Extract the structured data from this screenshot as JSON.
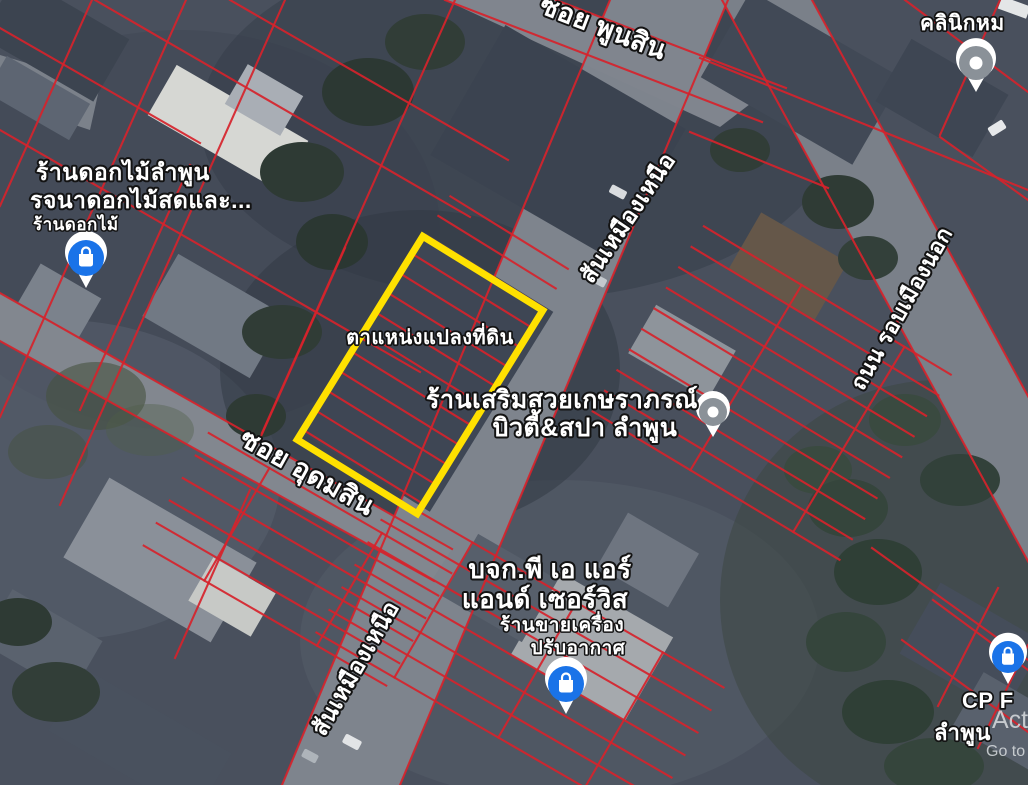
{
  "app": {
    "name": "satellite-map-with-land-parcel-overlay"
  },
  "colors": {
    "parcel_line": "#d6232b",
    "plot_outline": "#ffe100",
    "poi_blue": "#1a73e8",
    "poi_gray": "#8a9198",
    "road": "#7e848d"
  },
  "plot": {
    "label": "ตาแหน่งแปลงที่ดิน"
  },
  "streets": {
    "soi_phunsin": "ซอย พูนสิน",
    "san_mueang_nuea_top": "สันเหมืองเหนือ",
    "san_mueang_nuea_bottom": "สันเหมืองเหนือ",
    "soi_udomsin": "ซอย อุดมสิน",
    "thanon_rop_mueang_nok": "ถนน รอบเมืองนอก"
  },
  "places": {
    "flower_shop": {
      "line1": "ร้านดอกไม้ลำพูน",
      "line2": "รจนาดอกไม้สดและ...",
      "line3": "ร้านดอกไม้",
      "icon": "shopping-bag-pin"
    },
    "beauty_salon": {
      "line1": "ร้านเสริมสวยเกษราภรณ์",
      "line2": "บิวตี้&สปา ลำพูน",
      "icon": "generic-place-pin"
    },
    "aircon_company": {
      "line1": "บจก.พี เอ แอร์",
      "line2": "แอนด์ เซอร์วิส",
      "line3": "ร้านขายเครื่อง",
      "line4": "ปรับอากาศ",
      "icon": "shopping-bag-pin"
    },
    "clinic": {
      "line1": "คลินิกหม",
      "icon": "generic-place-pin"
    },
    "cp_store": {
      "line1": "CP F",
      "line2": "ลำพูน",
      "icon": "shopping-bag-pin"
    }
  },
  "watermark": {
    "line1": "Acti",
    "line2": "Go to"
  }
}
